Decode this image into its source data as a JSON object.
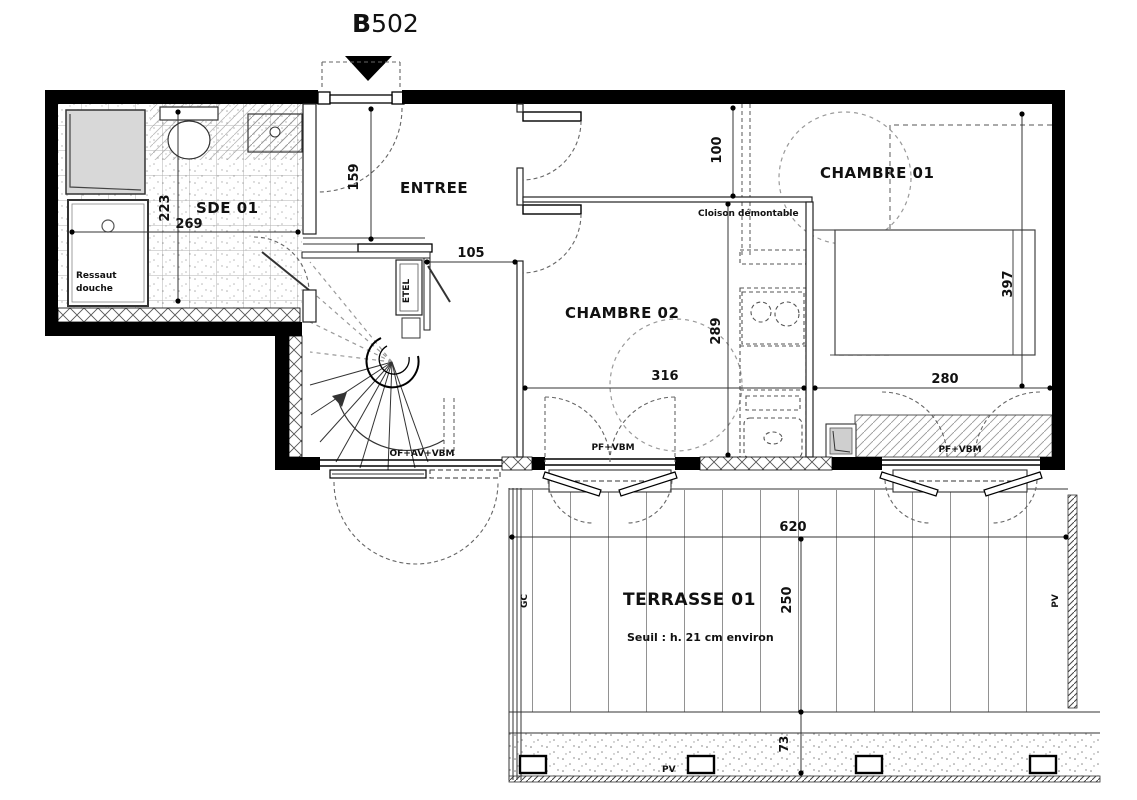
{
  "plan": {
    "unit": {
      "prefix": "B",
      "number": "502"
    },
    "rooms": {
      "sde": {
        "name": "SDE 01"
      },
      "entree": {
        "name": "ENTREE"
      },
      "chambre02": {
        "name": "CHAMBRE 02"
      },
      "chambre01": {
        "name": "CHAMBRE 01"
      },
      "terrasse": {
        "name": "TERRASSE 01",
        "note": "Seuil : h. 21 cm environ"
      }
    },
    "dimensions": {
      "sde_width": "269",
      "sde_height": "223",
      "entree_height": "159",
      "corridor": "105",
      "passage": "100",
      "chambre02_width": "316",
      "chambre02_height": "289",
      "chambre01_width": "280",
      "chambre01_height": "397",
      "terrasse_width": "620",
      "terrasse_depth": "250",
      "planter_depth": "73"
    },
    "annotations": {
      "ressaut_line1": "Ressaut",
      "ressaut_line2": "douche",
      "cloison": "Cloison démontable",
      "etel": "ETEL",
      "window_stair": "OF+AV+VBM",
      "window_chambre02": "PF+VBM",
      "window_chambre01": "PF+VBM",
      "gc": "GC",
      "pv_screen": "PV",
      "pv_post": "PV"
    },
    "colors": {
      "wall": "#000000",
      "text": "#111111",
      "shower_fill": "#d8d8d8"
    }
  }
}
